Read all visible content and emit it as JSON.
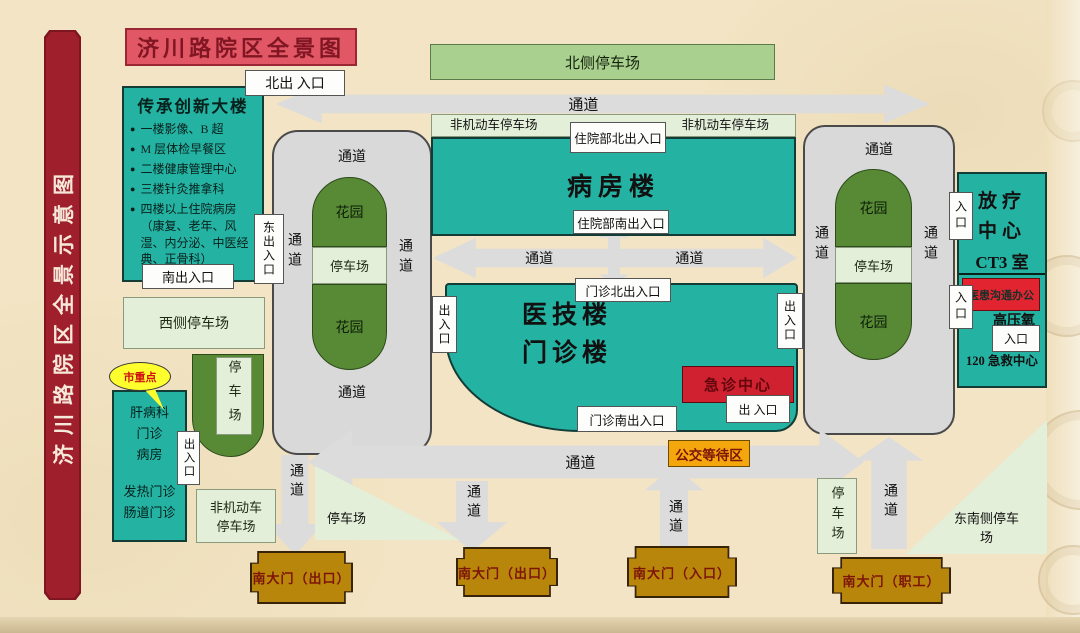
{
  "header": {
    "title": "济川路院区全景图",
    "ribbon": "济川路院区全景示意图"
  },
  "labels": {
    "channel": "通道",
    "garden": "花园",
    "parking": "停车场",
    "entrance": "入口",
    "exit_entrance": "出入口",
    "exit_entrance_spaced": "出 入口"
  },
  "heritage_building": {
    "name": "传承创新大楼",
    "north_door": "北出 入口",
    "south_door": "南出入口",
    "east_door": "东出入口",
    "items": [
      "一楼影像、B 超",
      "M 层体检早餐区",
      "二楼健康管理中心",
      "三楼针灸推拿科",
      "四楼以上住院病房（康复、老年、风湿、内分泌、中医经典、正骨科）"
    ]
  },
  "north_area": {
    "north_parking": "北侧停车场",
    "nonmotor_parking": "非机动车停车场",
    "inpatient_north_door": "住院部北出入口"
  },
  "ward_building": {
    "name": "病房楼",
    "south_door": "住院部南出入口"
  },
  "clinic_building": {
    "name_line1": "医技楼",
    "name_line2": "门诊楼",
    "north_door": "门诊北出入口",
    "south_door": "门诊南出入口"
  },
  "emergency_center": {
    "name": "急诊中心"
  },
  "bus_area": {
    "name": "公交等待区"
  },
  "radiotherapy_building": {
    "name_line1": "放疗",
    "name_line2": "中心",
    "ct3_room": "CT3 室",
    "comm_office": "医患沟通办公",
    "hyperbaric_oxygen": "高压氧",
    "rescue_center": "120 急救中心"
  },
  "west_area": {
    "west_parking": "西侧停车场",
    "city_key_badge": "市重点",
    "liver_lines": [
      "肝病科",
      "门诊",
      "病房"
    ],
    "clinic_lines": [
      "发热门诊",
      "肠道门诊"
    ],
    "nonmotor_parking_line1": "非机动车",
    "nonmotor_parking_line2": "停车场"
  },
  "south_area": {
    "se_parking_line1": "东南侧停车",
    "se_parking_line2": "场",
    "gates": [
      "南大门（出口）",
      "南大门（出口）",
      "南大门（入口）",
      "南大门（职工）"
    ]
  },
  "colors": {
    "teal": "#24b2a2",
    "title_banner_red": "#e25766",
    "ribbon_dark_red": "#a01f2c",
    "emergency_red": "#cf2130",
    "comm_office_red": "#e1242f",
    "gate_gold": "#b8860b",
    "bus_orange": "#f3a70c",
    "garden_green": "#588a35",
    "parking_light_green": "#a9d08e",
    "parking_pale_green": "#e3efd8",
    "corridor_gray": "#d9d9d9",
    "callout_yellow": "#ffff2e",
    "background": "#f2e4c4"
  }
}
